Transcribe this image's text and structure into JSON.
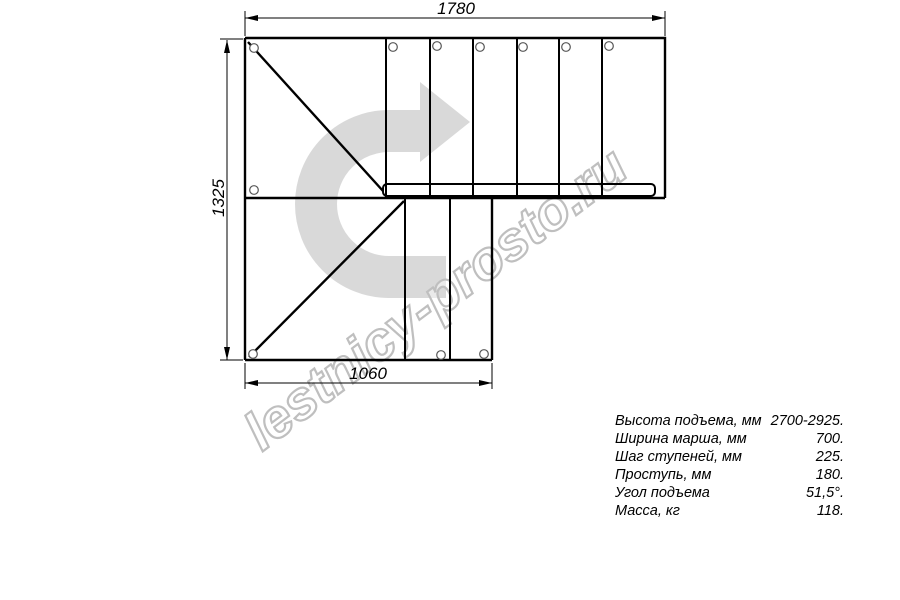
{
  "drawing": {
    "dimensions": {
      "top": "1780",
      "left": "1325",
      "bottom": "1060"
    },
    "watermark": "lestnicy-prosto.ru"
  },
  "icons": {
    "direction_arrow": "u-turn-right-arrow"
  },
  "specs": {
    "rows": [
      {
        "label": "Высота подъема, мм",
        "value": "2700-2925."
      },
      {
        "label": "Ширина марша, мм",
        "value": "700."
      },
      {
        "label": "Шаг ступеней, мм",
        "value": "225."
      },
      {
        "label": "Проступь, мм",
        "value": "180."
      },
      {
        "label": "Угол подъема",
        "value": "51,5°."
      },
      {
        "label": "Масса, кг",
        "value": "118."
      }
    ]
  },
  "colors": {
    "line": "#000000",
    "arrow_fill": "#d9d9d9",
    "watermark_outline": "#bfbfbf",
    "background": "#ffffff"
  }
}
